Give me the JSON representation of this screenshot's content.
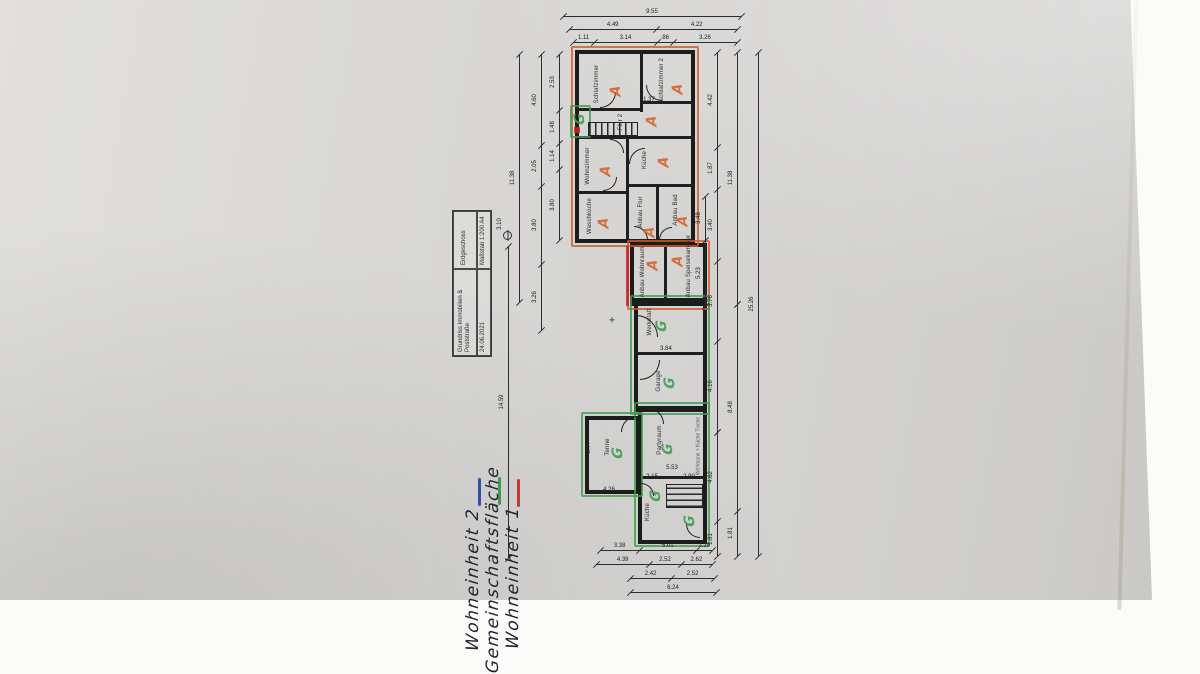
{
  "document": {
    "type": "floor-plan-photo",
    "orientation": "rotated-90ccw"
  },
  "title_block": {
    "company_line1": "Grundriss Immobilien &",
    "company_line2": "Poststraße",
    "date": "24.06.2021",
    "floor": "Erdgeschoss",
    "scale": "Maßstab 1:200  A4"
  },
  "legend": {
    "items": [
      {
        "color": "#c23b2e",
        "label": "Wohneinheit 1"
      },
      {
        "color": "#3f9b4f",
        "label": "Gemeinschaftsfläche"
      },
      {
        "color": "#2c4fae",
        "label": "Wohneinheit 2"
      }
    ]
  },
  "units": {
    "a_mark": "A",
    "a_color": "#d4622a",
    "g_mark": "G",
    "g_color": "#3f9b4f"
  },
  "plan": {
    "rooms": [
      {
        "label": "Schlafzimmer",
        "lx": 597,
        "ly": 84
      },
      {
        "label": "Schlafzimmer 2",
        "lx": 662,
        "ly": 80
      },
      {
        "label": "Flur 2",
        "lx": 621,
        "ly": 122
      },
      {
        "label": "Wohnzimmer",
        "lx": 588,
        "ly": 166
      },
      {
        "label": "Küche",
        "lx": 645,
        "ly": 160
      },
      {
        "label": "Waschküche",
        "lx": 590,
        "ly": 216
      },
      {
        "label": "Anbau Flur",
        "lx": 641,
        "ly": 212
      },
      {
        "label": "Anbau Bad",
        "lx": 676,
        "ly": 210
      },
      {
        "label": "Anbau Wohnraum",
        "lx": 643,
        "ly": 272
      },
      {
        "label": "Anbau Speisekammer",
        "lx": 689,
        "ly": 266
      },
      {
        "label": "Werkstatt",
        "lx": 650,
        "ly": 322
      },
      {
        "label": "Garage",
        "lx": 659,
        "ly": 381
      },
      {
        "label": "Tenne",
        "lx": 608,
        "ly": 447
      },
      {
        "label": "Partyraum",
        "lx": 660,
        "ly": 440
      },
      {
        "label": "Küche",
        "lx": 648,
        "ly": 512
      }
    ],
    "marks": [
      {
        "t": "A",
        "x": 616,
        "y": 91
      },
      {
        "t": "A",
        "x": 678,
        "y": 89
      },
      {
        "t": "A",
        "x": 652,
        "y": 121
      },
      {
        "t": "A",
        "x": 606,
        "y": 171
      },
      {
        "t": "A",
        "x": 664,
        "y": 162
      },
      {
        "t": "A",
        "x": 604,
        "y": 223
      },
      {
        "t": "A",
        "x": 650,
        "y": 232
      },
      {
        "t": "A",
        "x": 683,
        "y": 221
      },
      {
        "t": "A",
        "x": 653,
        "y": 265
      },
      {
        "t": "A",
        "x": 678,
        "y": 261
      },
      {
        "t": "G",
        "x": 662,
        "y": 326
      },
      {
        "t": "G",
        "x": 670,
        "y": 383
      },
      {
        "t": "G",
        "x": 618,
        "y": 453
      },
      {
        "t": "G",
        "x": 668,
        "y": 449
      },
      {
        "t": "G",
        "x": 656,
        "y": 496
      },
      {
        "t": "G",
        "x": 690,
        "y": 521
      },
      {
        "t": "G",
        "x": 580,
        "y": 119
      }
    ],
    "annotation": {
      "label": "Werkbank + Küche Tische",
      "x": 699,
      "y": 446
    },
    "outer_walls": [
      [
        575,
        50,
        120,
        193
      ],
      [
        630,
        243,
        77,
        63
      ],
      [
        634,
        298,
        73,
        114
      ],
      [
        585,
        416,
        55,
        78
      ],
      [
        638,
        406,
        69,
        138
      ]
    ],
    "walls": [
      [
        640,
        50,
        3,
        62
      ],
      [
        575,
        108,
        68,
        3
      ],
      [
        640,
        101,
        53,
        3
      ],
      [
        575,
        136,
        120,
        3
      ],
      [
        626,
        136,
        3,
        107
      ],
      [
        575,
        191,
        54,
        3
      ],
      [
        626,
        184,
        69,
        3
      ],
      [
        656,
        184,
        3,
        59
      ],
      [
        664,
        243,
        3,
        63
      ],
      [
        634,
        352,
        73,
        3
      ],
      [
        638,
        476,
        69,
        3
      ]
    ],
    "stairs": [
      {
        "x": 588,
        "y": 122,
        "w": 50,
        "h": 14,
        "v": false
      },
      {
        "x": 666,
        "y": 484,
        "w": 37,
        "h": 24,
        "v": true
      }
    ],
    "outlines": [
      {
        "x": 571,
        "y": 46,
        "w": 128,
        "h": 201,
        "c": "#cf5b28"
      },
      {
        "x": 627,
        "y": 240,
        "w": 83,
        "h": 70,
        "c": "#cf5b28"
      },
      {
        "x": 630,
        "y": 295,
        "w": 80,
        "h": 120,
        "c": "#3f9b4f"
      },
      {
        "x": 581,
        "y": 412,
        "w": 62,
        "h": 85,
        "c": "#3f9b4f"
      },
      {
        "x": 634,
        "y": 402,
        "w": 76,
        "h": 145,
        "c": "#3f9b4f"
      },
      {
        "x": 570,
        "y": 105,
        "w": 21,
        "h": 33,
        "c": "#3f9b4f"
      }
    ],
    "fills": [
      {
        "x": 626,
        "y": 246,
        "w": 3,
        "h": 60,
        "c": "#cc2222"
      },
      {
        "x": 574,
        "y": 127,
        "w": 6,
        "h": 6,
        "c": "#cc2222"
      }
    ],
    "doors": [
      [
        600,
        92,
        16,
        "br"
      ],
      [
        646,
        85,
        16,
        "bl"
      ],
      [
        610,
        139,
        14,
        "tr"
      ],
      [
        629,
        148,
        16,
        "tl"
      ],
      [
        603,
        177,
        14,
        "br"
      ],
      [
        634,
        226,
        14,
        "tr"
      ],
      [
        659,
        227,
        13,
        "tl"
      ],
      [
        636,
        315,
        22,
        "tr"
      ],
      [
        640,
        360,
        20,
        "br"
      ],
      [
        621,
        416,
        16,
        "tl"
      ],
      [
        648,
        408,
        16,
        "tr"
      ],
      [
        641,
        483,
        13,
        "tr"
      ],
      [
        686,
        524,
        14,
        "bl"
      ]
    ],
    "dims": {
      "chains": [
        {
          "o": "h",
          "x1": 563,
          "x2": 741,
          "y": 16,
          "segs": [
            "9.55"
          ],
          "fr": [
            1
          ]
        },
        {
          "o": "h",
          "x1": 569,
          "x2": 737,
          "y": 29,
          "segs": [
            "4.49",
            "4.22"
          ],
          "fr": [
            52,
            48
          ]
        },
        {
          "o": "h",
          "x1": 573,
          "x2": 737,
          "y": 42,
          "segs": [
            "1.11",
            "3.14",
            ".86",
            "3.26"
          ],
          "fr": [
            13,
            38,
            10,
            39
          ]
        },
        {
          "o": "v",
          "x": 559,
          "y1": 54,
          "y2": 240,
          "segs": [
            "2.53",
            "1.48",
            "1.14",
            "3.80"
          ],
          "fr": [
            30,
            18,
            14,
            38
          ]
        },
        {
          "o": "v",
          "x": 541,
          "y1": 54,
          "y2": 330,
          "segs": [
            "4.60",
            "2.05",
            "3.80",
            "3.26"
          ],
          "fr": [
            33,
            15,
            28,
            24
          ]
        },
        {
          "o": "v",
          "x": 519,
          "y1": 54,
          "y2": 302,
          "segs": [
            "11.38"
          ],
          "fr": [
            1
          ]
        },
        {
          "o": "v",
          "x": 508,
          "y1": 246,
          "y2": 558,
          "segs": [
            "14.59"
          ],
          "fr": [
            1
          ]
        },
        {
          "o": "v",
          "x": 705,
          "y1": 196,
          "y2": 306,
          "segs": [
            "3.48",
            "5.23"
          ],
          "fr": [
            40,
            60
          ]
        },
        {
          "o": "v",
          "x": 717,
          "y1": 52,
          "y2": 432,
          "segs": [
            "4.42",
            "1.87",
            "3.40",
            "3.76",
            "4.16"
          ],
          "fr": [
            25,
            11,
            19,
            21,
            24
          ]
        },
        {
          "o": "v",
          "x": 717,
          "y1": 432,
          "y2": 556,
          "segs": [
            "4.62",
            "1.81"
          ],
          "fr": [
            72,
            28
          ]
        },
        {
          "o": "v",
          "x": 737,
          "y1": 52,
          "y2": 304,
          "segs": [
            "11.38"
          ],
          "fr": [
            1
          ]
        },
        {
          "o": "v",
          "x": 737,
          "y1": 304,
          "y2": 556,
          "segs": [
            "8.48",
            "1.81"
          ],
          "fr": [
            82,
            18
          ]
        },
        {
          "o": "v",
          "x": 758,
          "y1": 52,
          "y2": 556,
          "segs": [
            "25.26"
          ],
          "fr": [
            1
          ]
        },
        {
          "o": "h",
          "x1": 600,
          "x2": 712,
          "y": 550,
          "segs": [
            "3.38",
            "5.01",
            "1.29"
          ],
          "fr": [
            35,
            51,
            14
          ]
        },
        {
          "o": "h",
          "x1": 596,
          "x2": 712,
          "y": 564,
          "segs": [
            "4.39",
            "2.52",
            "2.62"
          ],
          "fr": [
            46,
            27,
            27
          ]
        },
        {
          "o": "h",
          "x1": 630,
          "x2": 714,
          "y": 578,
          "segs": [
            "2.42",
            "2.52"
          ],
          "fr": [
            49,
            51
          ]
        },
        {
          "o": "h",
          "x1": 630,
          "x2": 716,
          "y": 592,
          "segs": [
            "6.24"
          ],
          "fr": [
            1
          ]
        }
      ],
      "floating": [
        {
          "t": "1.37",
          "x": 649,
          "y": 100
        },
        {
          "t": "3.84",
          "x": 666,
          "y": 349
        },
        {
          "t": "5.53",
          "x": 672,
          "y": 468
        },
        {
          "t": "2.15",
          "x": 652,
          "y": 477
        },
        {
          "t": "2.90",
          "x": 689,
          "y": 477
        },
        {
          "t": "6.44",
          "x": 589,
          "y": 448,
          "r": -90
        },
        {
          "t": "4.26",
          "x": 609,
          "y": 490
        },
        {
          "t": "3.10",
          "x": 500,
          "y": 224,
          "r": -90
        }
      ]
    },
    "symbols": {
      "register_cross": {
        "x": 612,
        "y": 321
      },
      "circle_cross": {
        "x": 503,
        "y": 231
      }
    }
  }
}
